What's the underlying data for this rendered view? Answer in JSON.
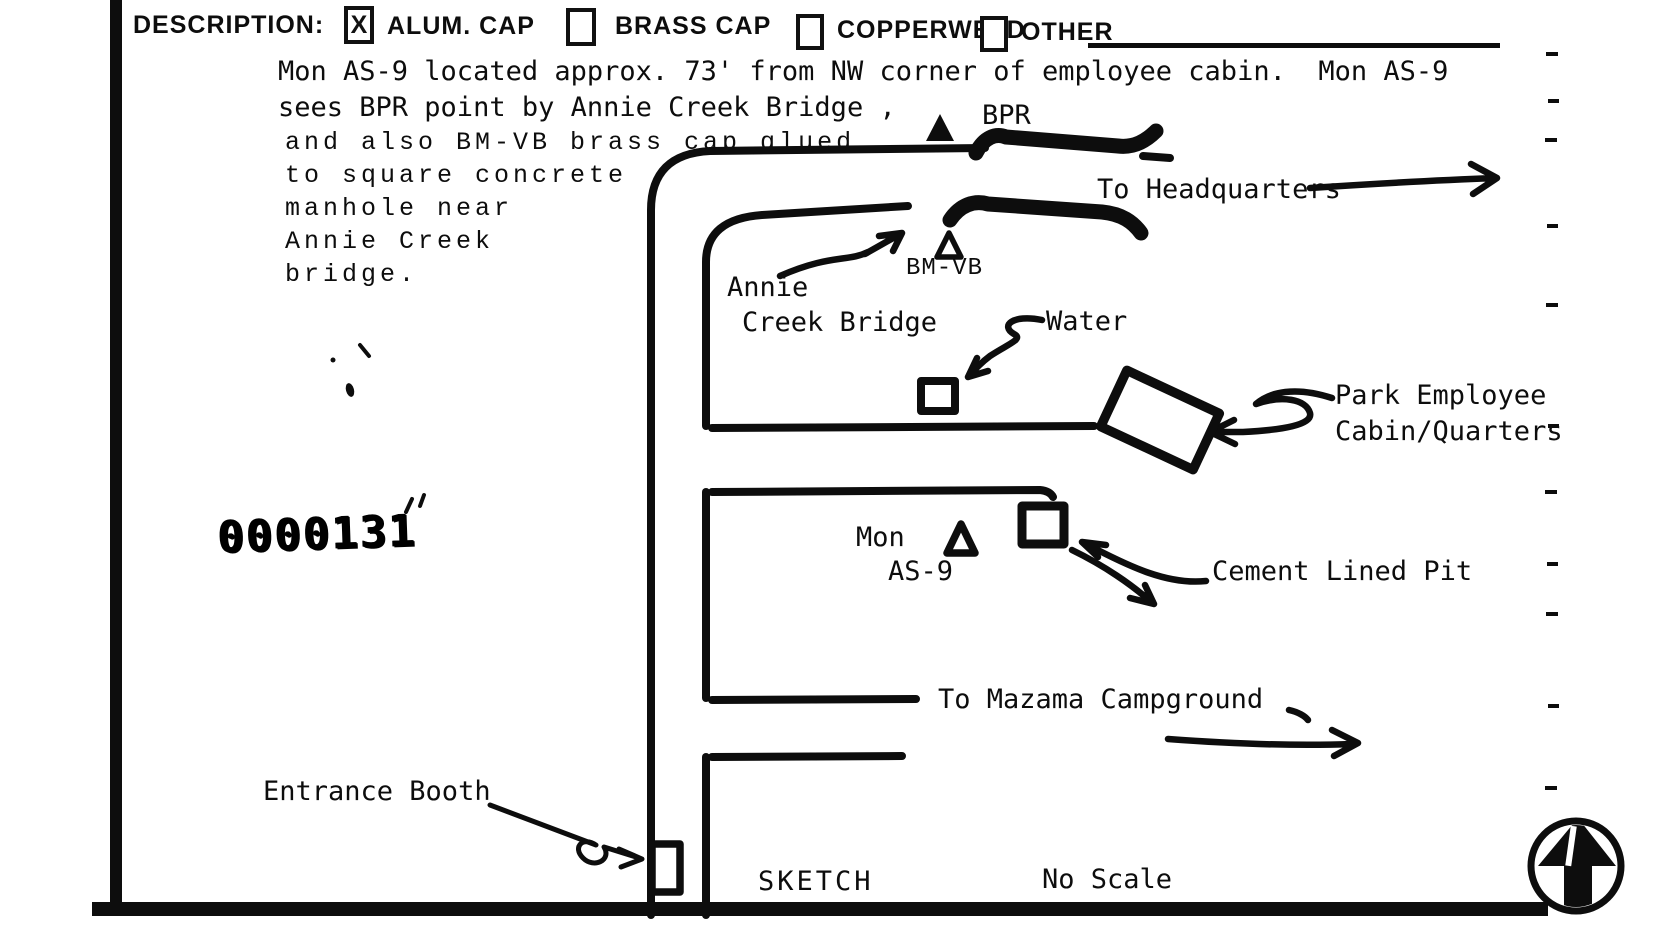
{
  "form": {
    "description_label": "DESCRIPTION:",
    "checkboxes": [
      {
        "label": "ALUM. CAP",
        "mark": "X"
      },
      {
        "label": "BRASS CAP",
        "mark": ""
      },
      {
        "label": "COPPERWELD",
        "mark": ""
      },
      {
        "label": "OTHER",
        "mark": ""
      }
    ]
  },
  "notes": {
    "line1": "Mon AS-9 located approx. 73' from NW corner of employee cabin.  Mon AS-9",
    "line2": "sees BPR point by Annie Creek Bridge ,",
    "col_line1": "and also BM-VB brass cap glued",
    "col_line2": "to square concrete",
    "col_line3": "manhole near",
    "col_line4": "Annie Creek",
    "col_line5": "bridge."
  },
  "stamp": "0000131",
  "sketch": {
    "labels": {
      "bpr": "BPR",
      "bm_vb": "BM-VB",
      "to_headquarters": "To Headquarters",
      "annie_line1": "Annie",
      "annie_line2": "Creek Bridge",
      "water": "Water",
      "park_line1": "Park Employee",
      "park_line2": "Cabin/Quarters",
      "mon": "Mon",
      "as9": "AS-9",
      "cement_pit": "Cement Lined Pit",
      "to_mazama": "To Mazama Campground",
      "entrance_booth": "Entrance Booth",
      "sketch_caption": "SKETCH",
      "no_scale": "No Scale"
    },
    "colors": {
      "ink": "#0d0d0d",
      "paper": "#ffffff"
    }
  }
}
